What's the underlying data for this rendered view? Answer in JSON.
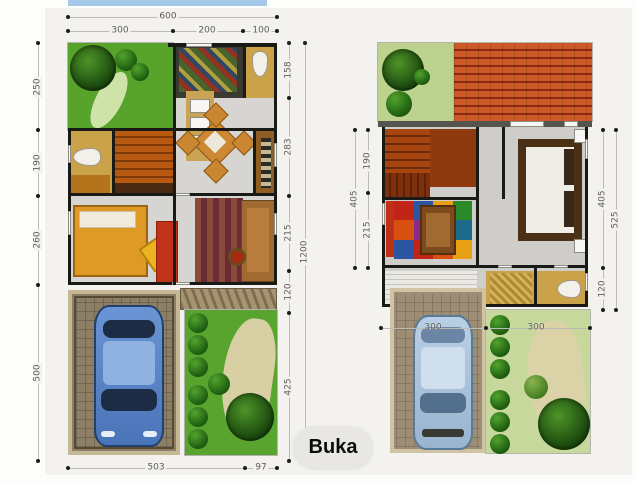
{
  "overlay": {
    "open_button": "Buka"
  },
  "colors": {
    "top_bar": "#a5c8e9",
    "canvas_bg": "#f3f2ee",
    "open_button_bg": "#e9e7e4",
    "wall": "#191916",
    "garden_green": "#57a32c",
    "upper_garden_green": "#bdd28f",
    "roof_orange": "#b0431c",
    "car_first_floor": "#4d7fc4",
    "car_second_floor": "#a9c3de"
  },
  "plans": {
    "first_floor": {
      "dims": {
        "top_overall": "600",
        "top_segments": [
          "300",
          "200",
          "100"
        ],
        "left": [
          "250",
          "190",
          "260",
          "500"
        ],
        "right": [
          "158",
          "283",
          "215",
          "120",
          "425"
        ],
        "right_overall": "1200",
        "bottom": [
          "503",
          "97"
        ]
      }
    },
    "second_floor": {
      "dims": {
        "left": [
          "190",
          "215"
        ],
        "left_overall": "405",
        "right": [
          "405",
          "120"
        ],
        "right_overall": "525",
        "width_segments": [
          "300",
          "300"
        ]
      }
    }
  }
}
